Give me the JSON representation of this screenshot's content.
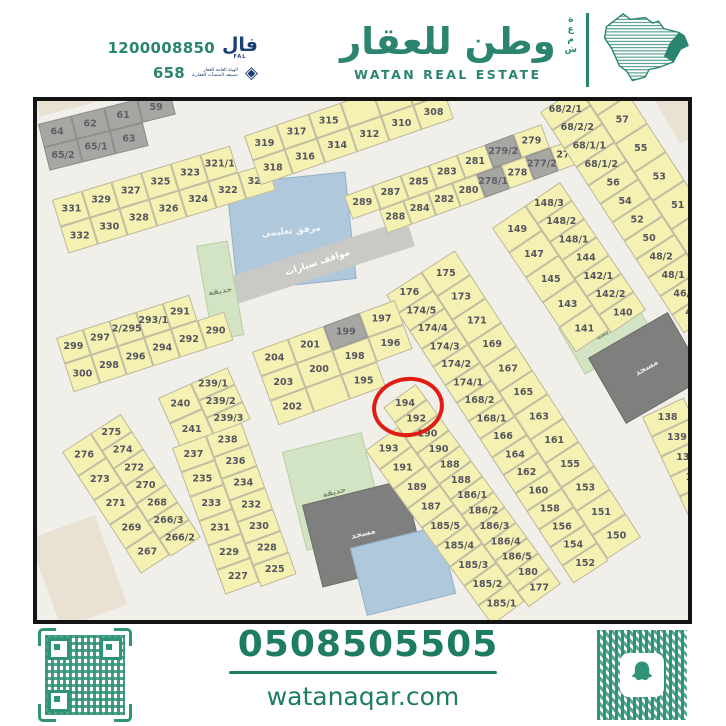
{
  "header": {
    "license_number": "1200008850",
    "license_logo_ar": "فال",
    "license_logo_en": "FAL",
    "classification_number": "658",
    "rega_line1": "الهيئة العامة للعقار",
    "rega_line2": "تصنيف المنشآت العقارية",
    "brand_ar": "وطن للعقار",
    "brand_en": "WATAN REAL ESTATE",
    "brand_side_ar": "شمعة",
    "brand_green": "#2a8470",
    "navy": "#1d3f74"
  },
  "footer": {
    "phone": "0508505505",
    "website": "watanaqar.com",
    "green": "#1d7c62"
  },
  "map": {
    "highlight_plot": "194",
    "plot_yellow": "#f5f1b2",
    "circle_red": "#e01d15",
    "facilities": [
      {
        "name": "sand-top-left",
        "label": "",
        "x": -2,
        "y": -4,
        "w": 160,
        "h": 20,
        "rot": -14,
        "type": "sand"
      },
      {
        "name": "sand-bottom-left",
        "label": "",
        "x": -8,
        "y": 438,
        "w": 70,
        "h": 95,
        "rot": -20,
        "type": "sand"
      },
      {
        "name": "sand-top-right",
        "label": "",
        "x": 616,
        "y": -4,
        "w": 44,
        "h": 54,
        "rot": -30,
        "type": "sand"
      },
      {
        "name": "school-facility",
        "label": "مرفق تعليمي",
        "x": 189,
        "y": 83,
        "w": 120,
        "h": 108,
        "rot": -6,
        "type": "blue"
      },
      {
        "name": "car-parking",
        "label": "مواقف سيارات",
        "x": 183,
        "y": 179,
        "w": 196,
        "h": 28,
        "rot": -18,
        "type": "road"
      },
      {
        "name": "garden-west",
        "label": "حديقة",
        "x": 159,
        "y": 145,
        "w": 32,
        "h": 96,
        "rot": -10,
        "type": "green"
      },
      {
        "name": "garden-mid",
        "label": "حديقة",
        "x": 521,
        "y": 227,
        "w": 80,
        "h": 54,
        "rot": -30,
        "type": "green"
      },
      {
        "name": "mosque-mid",
        "label": "مسجد",
        "x": 551,
        "y": 257,
        "w": 92,
        "h": 76,
        "rot": -30,
        "type": "mosque"
      },
      {
        "name": "garden-south",
        "label": "حديقة",
        "x": 245,
        "y": 351,
        "w": 82,
        "h": 102,
        "rot": -14,
        "type": "green"
      },
      {
        "name": "mosque-south",
        "label": "مسجد",
        "x": 265,
        "y": 404,
        "w": 105,
        "h": 85,
        "rot": -14,
        "type": "mosque"
      },
      {
        "name": "water-south",
        "label": "",
        "x": 313,
        "y": 447,
        "w": 92,
        "h": 70,
        "rot": -14,
        "type": "blue"
      }
    ],
    "blocks": [
      {
        "name": "block-gray-60s",
        "x": 1,
        "y": 23,
        "rot": -14,
        "dir": "rows",
        "color": "gray",
        "lines": [
          {
            "cells": [
              "64",
              "62",
              "61",
              "59"
            ],
            "w": 34,
            "h": 24
          },
          {
            "cells": [
              "65/2",
              "65/1",
              "63"
            ],
            "w": 34,
            "h": 24
          }
        ]
      },
      {
        "name": "block-320s-west",
        "x": 15,
        "y": 99,
        "rot": -17,
        "dir": "rows",
        "lines": [
          {
            "cells": [
              "331",
              "329",
              "327",
              "325",
              "323",
              "321/1"
            ],
            "w": 31,
            "h": 28
          },
          {
            "cells": [
              "332",
              "330",
              "328",
              "326",
              "324",
              "322",
              "320"
            ],
            "w": 31,
            "h": 28
          }
        ]
      },
      {
        "name": "block-310s",
        "x": 207,
        "y": 35,
        "rot": -19,
        "dir": "rows",
        "lines": [
          {
            "cells": [
              "319",
              "317",
              "315",
              "",
              "",
              ""
            ],
            "w": 34,
            "h": 26
          },
          {
            "cells": [
              "318",
              "316",
              "314",
              "312",
              "310",
              "308"
            ],
            "w": 34,
            "h": 26
          }
        ]
      },
      {
        "name": "block-280s",
        "x": 307,
        "y": 95,
        "rot": -20,
        "dir": "rows",
        "gray": [
          "279/2",
          "278/1",
          "277/2"
        ],
        "lines": [
          {
            "cells": [
              "289",
              "287",
              "285",
              "283",
              "281",
              "279/2",
              "279"
            ],
            "w": 30,
            "h": 25
          },
          {
            "cells": [
              "288",
              "284",
              "282",
              "280",
              "278/1",
              "278",
              "277/2",
              "277"
            ],
            "w": 26,
            "h": 25,
            "ml": 28
          }
        ]
      },
      {
        "name": "strip-50s-68s",
        "x": 503,
        "y": 11,
        "rot": -33,
        "dir": "cols",
        "lines": [
          {
            "cells": [
              "68/2/1",
              "68/2/2",
              "68/1/1",
              "68/1/2",
              "56",
              "54",
              "52",
              "50",
              "48/2",
              "48/1",
              "46/1",
              "46/2"
            ],
            "w": 46,
            "h": 22
          },
          {
            "cells": [
              "59",
              "57",
              "55",
              "53",
              "51",
              "49"
            ],
            "w": 38,
            "h": 34
          }
        ]
      },
      {
        "name": "strip-140s",
        "x": 455,
        "y": 127,
        "rot": -34,
        "dir": "cols",
        "lines": [
          {
            "cells": [
              "149",
              "147",
              "145",
              "143",
              "141"
            ],
            "w": 40,
            "h": 30
          },
          {
            "cells": [
              "148/3",
              "148/2",
              "148/1",
              "144",
              "142/1",
              "142/2",
              "140"
            ],
            "w": 42,
            "h": 22
          }
        ]
      },
      {
        "name": "strip-160s-170s",
        "x": 349,
        "y": 194,
        "rot": -33,
        "dir": "cols",
        "lines": [
          {
            "cells": [
              "176",
              "174/5",
              "174/4",
              "174/3",
              "174/2",
              "174/1",
              "168/2",
              "168/1",
              "166",
              "164",
              "162",
              "160",
              "158",
              "156",
              "154",
              "152"
            ],
            "w": 42,
            "h": 21.5
          },
          {
            "cells": [
              "175",
              "173",
              "171",
              "169",
              "167",
              "165",
              "163",
              "161",
              "155",
              "153",
              "151",
              "150"
            ],
            "w": 40,
            "h": 28.5
          }
        ]
      },
      {
        "name": "strip-180s-190s",
        "x": 314,
        "y": 330,
        "rot": -36,
        "dir": "cols",
        "lines": [
          {
            "cells": [
              "193",
              "191",
              "189",
              "187",
              "185/5",
              "185/4",
              "185/3",
              "185/2",
              "185/1"
            ],
            "w": 40,
            "h": 24,
            "mt": 24
          },
          {
            "cells": [
              "194",
              "192",
              "190",
              "190",
              "188",
              "188",
              "186/1",
              "186/2",
              "186/3",
              "186/4",
              "186/5",
              "180",
              "177"
            ],
            "w": 40,
            "h": 19
          }
        ]
      },
      {
        "name": "block-200s",
        "x": 215,
        "y": 251,
        "rot": -20,
        "dir": "rows",
        "gray": [
          "199"
        ],
        "lines": [
          {
            "cells": [
              "204",
              "201",
              "199",
              "197"
            ],
            "w": 38,
            "h": 26
          },
          {
            "cells": [
              "203",
              "200",
              "198",
              "196"
            ],
            "w": 38,
            "h": 26
          },
          {
            "cells": [
              "202",
              "",
              "195"
            ],
            "w": 38,
            "h": 26
          }
        ]
      },
      {
        "name": "block-290s",
        "x": 19,
        "y": 237,
        "rot": -18,
        "dir": "rows",
        "lines": [
          {
            "cells": [
              "299",
              "297",
              "2/295",
              "293/1",
              "291"
            ],
            "w": 28,
            "h": 27
          },
          {
            "cells": [
              "300",
              "298",
              "296",
              "294",
              "292",
              "290"
            ],
            "w": 28,
            "h": 30
          }
        ]
      },
      {
        "name": "block-239-241",
        "x": 121,
        "y": 297,
        "rot": -24,
        "dir": "cols",
        "lines": [
          {
            "cells": [
              "240",
              "241"
            ],
            "w": 36,
            "h": 28
          },
          {
            "cells": [
              "239/1",
              "239/2",
              "239/3"
            ],
            "w": 40,
            "h": 19
          }
        ]
      },
      {
        "name": "strip-266-276",
        "x": 25,
        "y": 351,
        "rot": -33,
        "dir": "cols",
        "lines": [
          {
            "cells": [
              "276",
              "273",
              "271",
              "269",
              "267"
            ],
            "w": 34,
            "h": 29
          },
          {
            "cells": [
              "275",
              "274",
              "272",
              "270",
              "268",
              "266/3",
              "266/2"
            ],
            "w": 36,
            "h": 21
          }
        ]
      },
      {
        "name": "strip-225-238",
        "x": 135,
        "y": 347,
        "rot": -20,
        "dir": "cols",
        "lines": [
          {
            "cells": [
              "237",
              "235",
              "233",
              "231",
              "229",
              "227"
            ],
            "w": 36,
            "h": 26
          },
          {
            "cells": [
              "238",
              "236",
              "234",
              "232",
              "230",
              "228",
              "225"
            ],
            "w": 38,
            "h": 23
          }
        ]
      },
      {
        "name": "strip-130s",
        "x": 605,
        "y": 316,
        "rot": -25,
        "dir": "cols",
        "lines": [
          {
            "cells": [
              "138",
              "139",
              "137",
              "135",
              "13"
            ],
            "w": 46,
            "h": 22
          }
        ]
      }
    ]
  }
}
